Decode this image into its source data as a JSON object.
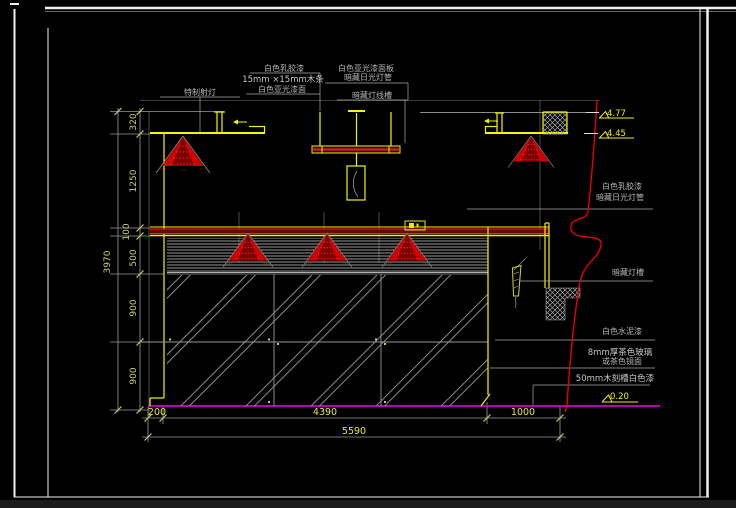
{
  "drawing": {
    "labels": {
      "top": {
        "spotlight": "特制射灯",
        "c1": [
          "白色乳胶漆",
          "15mm ×15mm木条",
          "白色亚光漆面"
        ],
        "c2": [
          "白色亚光漆面板",
          "暗藏日光灯管",
          "暗藏灯线槽"
        ]
      },
      "right": {
        "r1a": "白色乳胶漆",
        "r1b": "暗藏日光灯管",
        "r2": "暗藏灯槽",
        "r3": "白色水泥漆",
        "r4a": "8mm厚茶色玻璃",
        "r4b": "或茶色镜面",
        "r5": "50mm木刻槽白色漆"
      }
    },
    "elevations": {
      "upper": "4.77",
      "lower": "4.45",
      "floor": "0.20"
    },
    "dimensions": {
      "left_total": "3970",
      "left_chain": [
        "320",
        "1250",
        "100",
        "500",
        "900",
        "900"
      ],
      "bottom_chain": [
        "200",
        "4390",
        "1000"
      ],
      "bottom_total": "5590"
    },
    "colors": {
      "background": "#000000",
      "line_primary_yellow": "#f5f500",
      "accent_red": "#e60000",
      "band_fill_red": "#6e0000",
      "floor_line_magenta": "#d000d0",
      "dim_line_gray": "#9a9a9a",
      "label_text_gray": "#b5b5b5",
      "dim_text_yellow": "#e8e830",
      "frame_white": "#f0f0f0"
    }
  }
}
